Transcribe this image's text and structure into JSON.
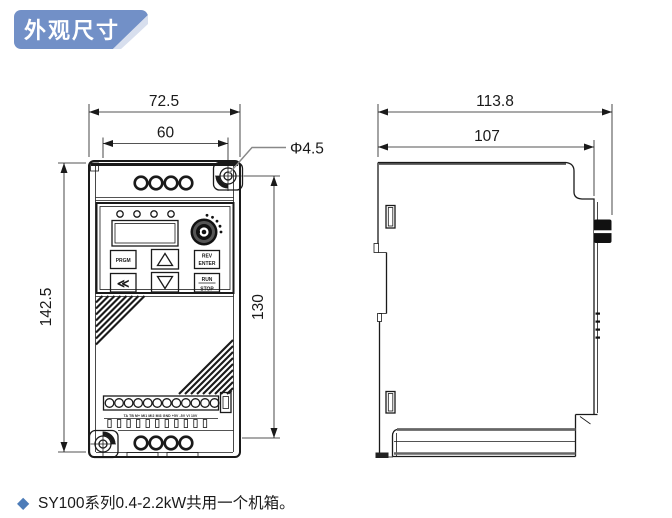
{
  "title_badge": {
    "label": "外观尺寸",
    "bg_color": "#7290c7",
    "text_color": "#ffffff"
  },
  "front_view": {
    "dimensions": {
      "overall_width": "72.5",
      "mounting_width": "60",
      "mounting_hole_diameter": "Φ4.5",
      "overall_height": "142.5",
      "mounting_height": "130"
    },
    "keypad": {
      "prgm": "PRGM",
      "back": "≪",
      "rev": "REV",
      "enter": "ENTER",
      "run": "RUN",
      "stop": "STOP"
    },
    "terminal_row_label": "TA TB M+ MI1 MI2 MI3 GND +5V -5V VI 10V"
  },
  "side_view": {
    "dimensions": {
      "overall_depth": "113.8",
      "body_depth": "107"
    }
  },
  "footnote": {
    "bullet": "◆",
    "text": "SY100系列0.4-2.2kW共用一个机箱。"
  },
  "colors": {
    "line": "#1a1a1a",
    "badge_blue": "#7290c7",
    "bullet_blue": "#4d7cb8",
    "leader_gray": "#888888"
  }
}
